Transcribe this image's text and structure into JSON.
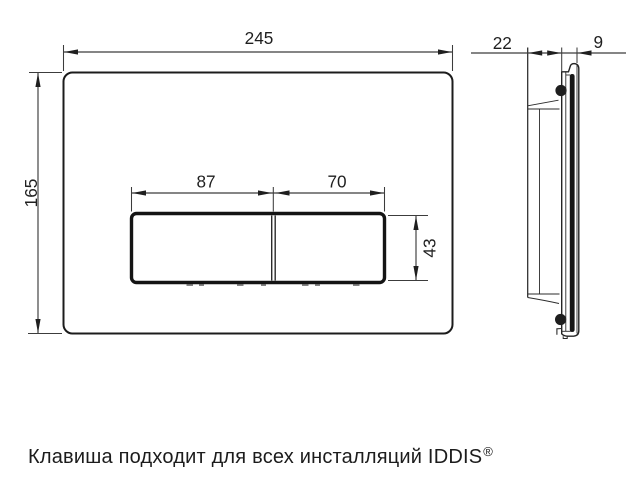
{
  "drawing": {
    "front_view": {
      "width_mm": "245",
      "height_mm": "165",
      "left_button_width_mm": "87",
      "right_button_width_mm": "70",
      "button_height_mm": "43"
    },
    "side_view": {
      "depth_mm": "22",
      "plate_thickness_mm": "9"
    }
  },
  "caption": {
    "text": "Клавиша подходит для всех инсталляций IDDIS",
    "trademark": "®"
  },
  "colors": {
    "background": "#ffffff",
    "line": "#1f1f1f",
    "text": "#1c1c1c"
  }
}
